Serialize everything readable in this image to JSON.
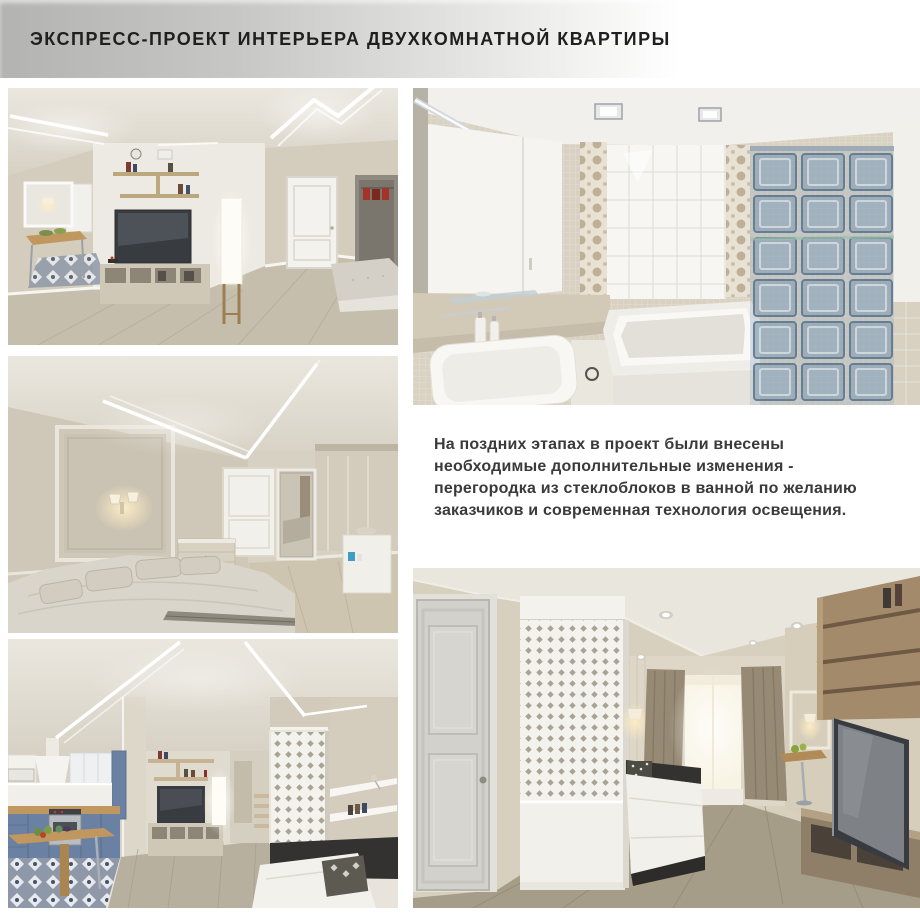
{
  "header": {
    "title": "ЭКСПРЕСС-ПРОЕКТ ИНТЕРЬЕРА ДВУХКОМНАТНОЙ КВАРТИРЫ"
  },
  "annotation": {
    "lines": [
      "На поздних этапах в проект были внесены",
      "необходимые дополнительные изменения -",
      "перегородка из стеклоблоков в ванной по желанию",
      "заказчиков и современная технология освещения."
    ]
  },
  "photos": {
    "living_room_tv": {
      "alt": "Гостиная с ТВ-зоной, стеллажами и LED-подсветкой потолка"
    },
    "bedroom": {
      "alt": "Спальня с бра, молдингами и диагональной LED-подсветкой"
    },
    "kitchen_living": {
      "alt": "Кухня-гостиная с синим гарнитуром и ажурной перегородкой"
    },
    "bathroom": {
      "alt": "Ванная с перегородкой из стеклоблоков"
    },
    "living_sofa": {
      "alt": "Гостиная с диваном, окном и ТВ-консолью"
    }
  },
  "palette": {
    "band-gray": "#b3b3b1",
    "title-dark": "#1f1f1f",
    "text-dark": "#3a3a3a",
    "wall-beige": "#d4cdbe",
    "wall-light": "#e8e4dc",
    "white-paint": "#f4f2ed",
    "floor-wood": "#c5beac",
    "floor-olive": "#a59d87",
    "tv-dark": "#383b3f",
    "kitchen-blue": "#6b81a3",
    "counter-wood": "#c0975f",
    "glass-blue": "#7d96ac",
    "accent-red": "#a43428",
    "sofa-dark": "#343230",
    "curtain-taupe": "#978a75",
    "ceiling-beige": "#ddd7ca"
  }
}
